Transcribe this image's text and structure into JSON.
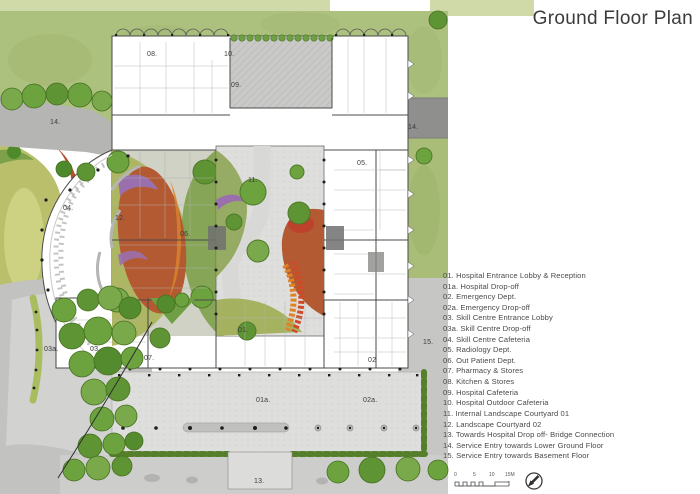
{
  "title": "Ground Floor Plan",
  "legend": {
    "items": [
      "01. Hospital Entrance Lobby & Reception",
      "01a. Hospital Drop-off",
      "02. Emergency Dept.",
      "02a. Emergency Drop-off",
      "03. Skill Centre Entrance Lobby",
      "03a. Skill Centre Drop-off",
      "04. Skill Centre Cafeteria",
      "05. Radiology Dept.",
      "06. Out Patient Dept.",
      "07. Pharmacy & Stores",
      "08. Kitchen & Stores",
      "09. Hospital Cafeteria",
      "10. Hospital Outdoor Cafeteria",
      "11. Internal Landscape Courtyard 01",
      "12. Landscape Courtyard 02",
      "13. Towards Hospital Drop off- Bridge Connection",
      "14. Service Entry towards Lower Ground Floor",
      "15. Service Entry towards Basement Floor"
    ]
  },
  "plan_labels": [
    {
      "text": "08."
    },
    {
      "text": "10."
    },
    {
      "text": "09."
    },
    {
      "text": "05."
    },
    {
      "text": "14."
    },
    {
      "text": "14."
    },
    {
      "text": "04."
    },
    {
      "text": "12."
    },
    {
      "text": "11."
    },
    {
      "text": "06."
    },
    {
      "text": "03a."
    },
    {
      "text": "03."
    },
    {
      "text": "07."
    },
    {
      "text": "01."
    },
    {
      "text": "02"
    },
    {
      "text": "15."
    },
    {
      "text": "01a."
    },
    {
      "text": "02a."
    },
    {
      "text": "13."
    }
  ],
  "scale_bar": {
    "ticks": [
      "0",
      "5",
      "10",
      "15M"
    ]
  },
  "colors": {
    "lawn": "#adc17e",
    "lawn_pale": "#cfdaa8",
    "tree": "#6da33f",
    "road": "#bdbdbb",
    "plaza": "#dededc",
    "terracotta": "#b45a32",
    "orange": "#d9822e",
    "purple": "#9a6fae",
    "olive": "#a8b259",
    "hedge": "#567f2b",
    "wall": "#4a4a4a"
  }
}
